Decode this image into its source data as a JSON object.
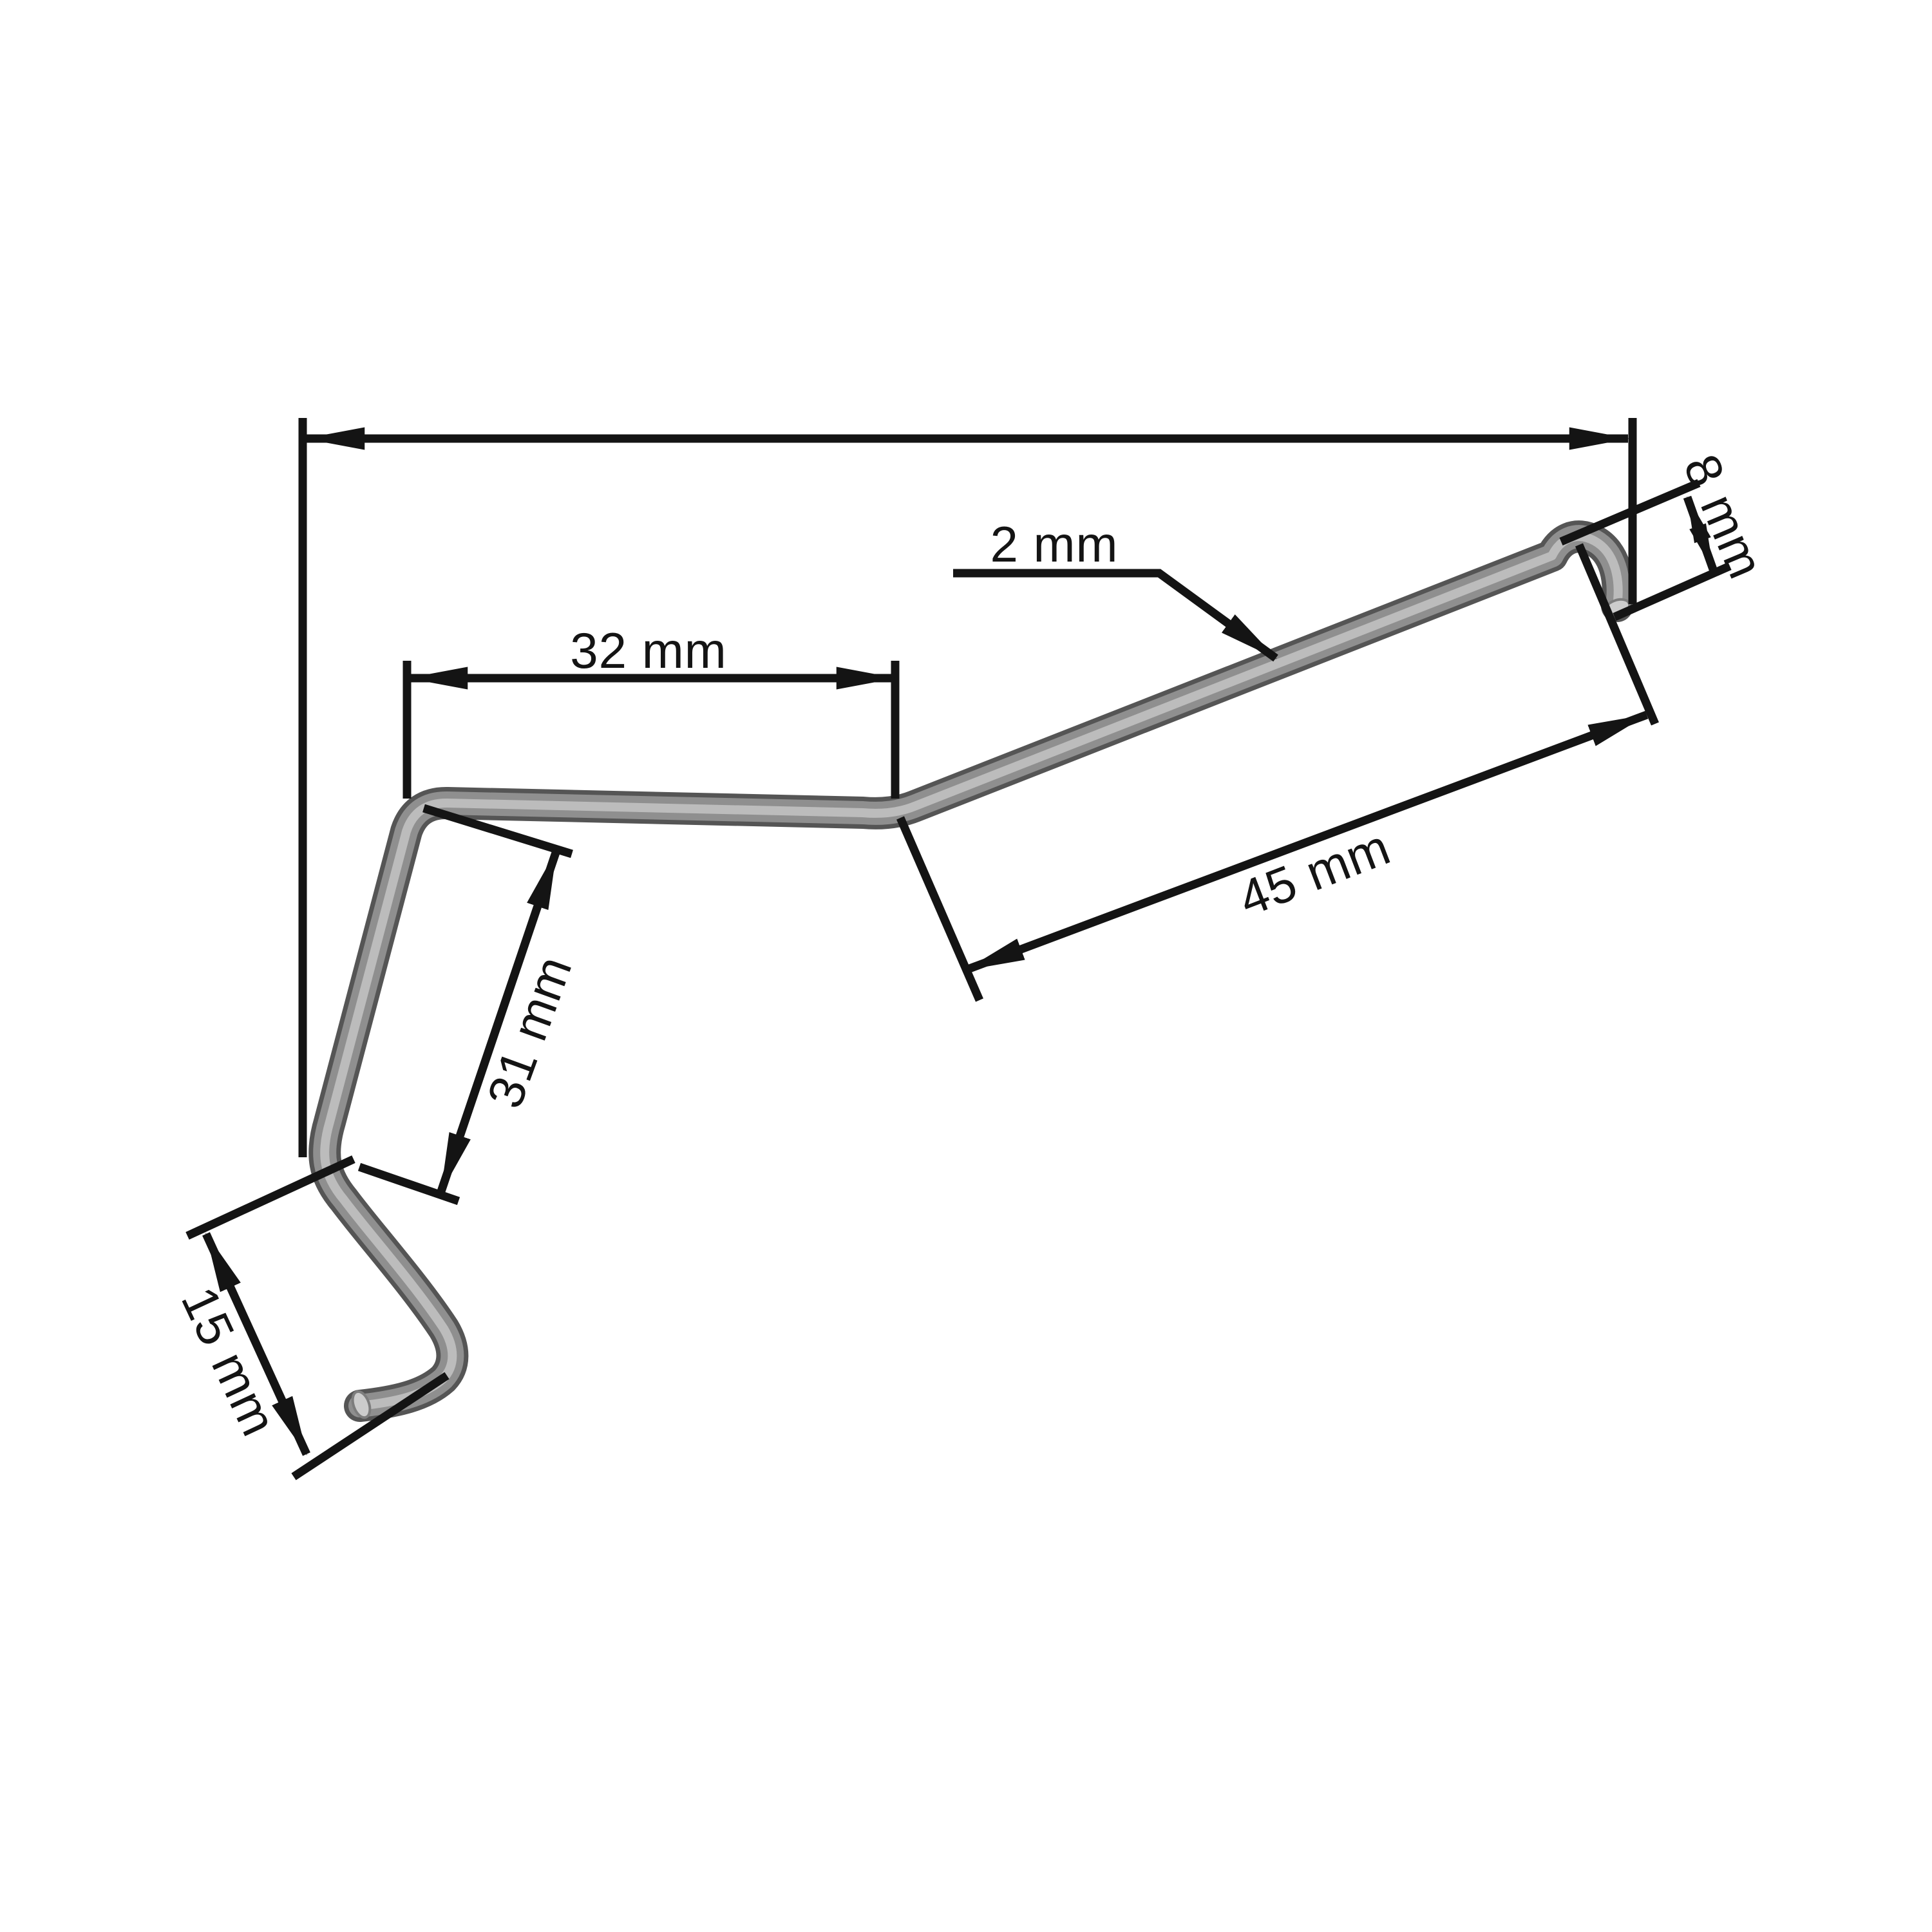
{
  "diagram": {
    "type": "technical-dimension-drawing",
    "subject": "bent-wire-spring-clip",
    "unit": "mm",
    "background_color": "#ffffff",
    "line_color": "#141414",
    "wire_base_color": "#555555",
    "wire_mid_color": "#8f8f8f",
    "wire_highlight_color": "#bcbcbc",
    "labels": [
      {
        "name": "wire-diameter",
        "text": "2 mm",
        "value": 2
      },
      {
        "name": "top-segment",
        "text": "32 mm",
        "value": 32
      },
      {
        "name": "diagonal-segment",
        "text": "45 mm",
        "value": 45
      },
      {
        "name": "side-segment",
        "text": "31 mm",
        "value": 31
      },
      {
        "name": "hook-width",
        "text": "15 mm",
        "value": 15
      },
      {
        "name": "end-hook-height",
        "text": "8 mm",
        "value": 8
      }
    ]
  }
}
